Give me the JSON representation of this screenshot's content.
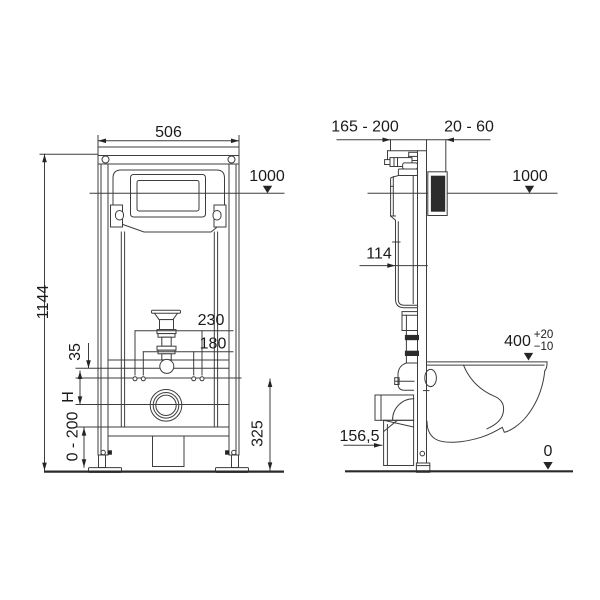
{
  "title": "Wall-hung WC installation frame — dimensional drawing",
  "front_view": {
    "width_top": "506",
    "height_total": "1144",
    "level_line": "1000",
    "bolt_span_outer": "230",
    "bolt_span_inner": "180",
    "bracket_thickness": "35",
    "outlet_height": "H",
    "foot_adjust_range": "0 - 200",
    "lower_section_height": "325"
  },
  "side_view": {
    "supply_offset_range": "165 - 200",
    "wall_finish_range": "20 - 60",
    "level_line": "1000",
    "tank_depth": "114",
    "seat_height": "400",
    "seat_tolerance_plus": "+20",
    "seat_tolerance_minus": "−10",
    "outlet_center_height": "156,5",
    "floor_level": "0"
  }
}
